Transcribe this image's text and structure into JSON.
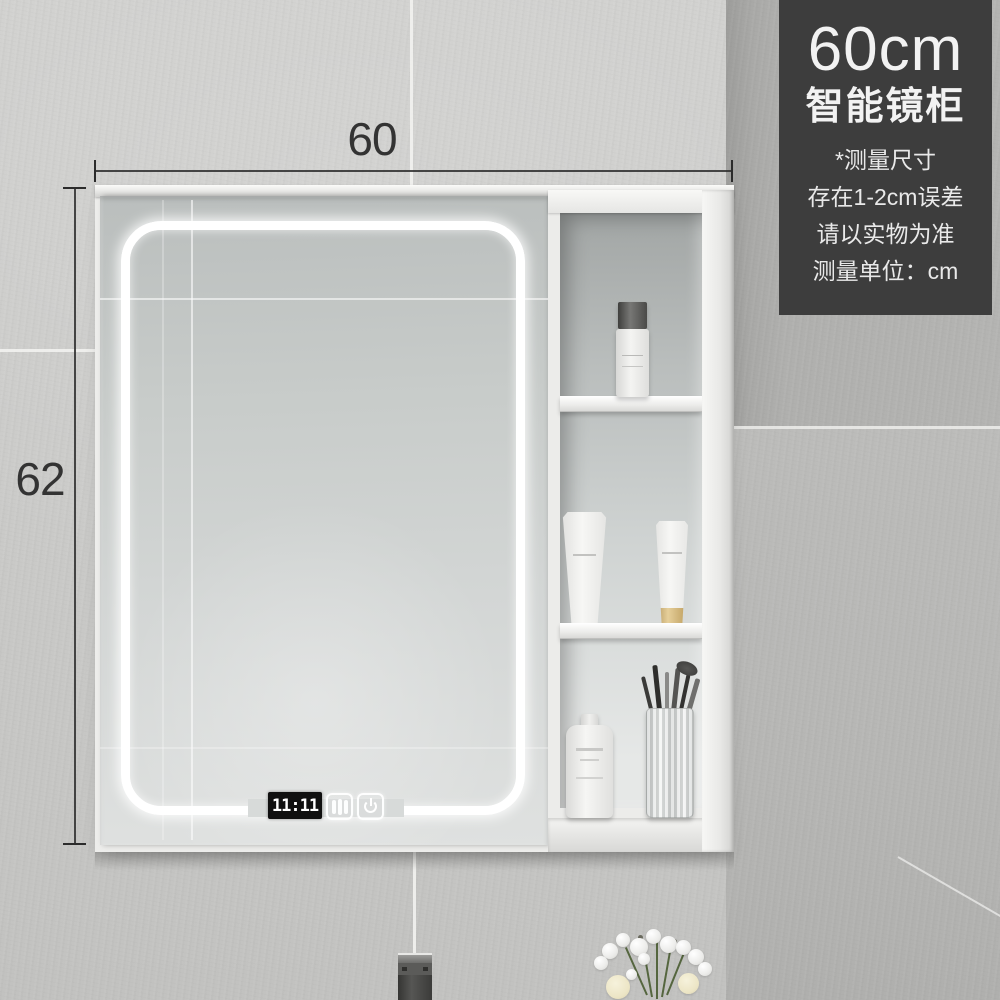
{
  "badge": {
    "size": "60cm",
    "title": "智能镜柜",
    "notes": [
      "*测量尺寸",
      "存在1-2cm误差",
      "请以实物为准",
      "测量单位：cm"
    ]
  },
  "dimensions": {
    "width": "60",
    "height": "62"
  },
  "mirror_display": {
    "time": "11:11",
    "icons": [
      "clock-display",
      "defogger-icon",
      "power-icon"
    ]
  },
  "colors": {
    "wall": "#cdcdcb",
    "wall_right": "#acacaa",
    "grout": "#f2f2f0",
    "dim": "#2b2b2b",
    "badge_bg": "#3d3d3d",
    "badge_text": "#f2f2f2",
    "led": "#ffffff",
    "clock_bg": "#101010",
    "clock_text": "#ffffff",
    "gold": "#e6cf9a",
    "faucet_dark": "#565654",
    "leaf_green": "#55663f"
  }
}
